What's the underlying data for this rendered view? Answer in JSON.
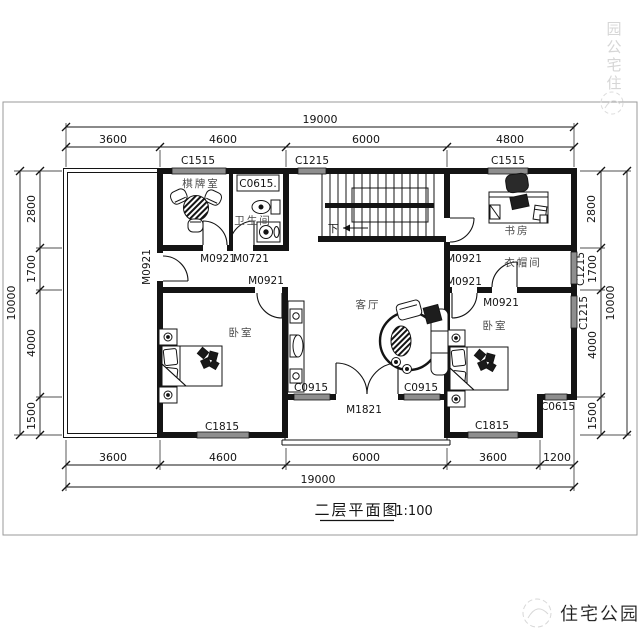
{
  "watermark": {
    "brand": "住宅公园",
    "vertical_chars": [
      "园",
      "公",
      "宅",
      "住"
    ]
  },
  "title": {
    "text": "二层平面图",
    "scale": "1:100"
  },
  "rooms": {
    "chess": "棋牌室",
    "bath": "卫生间",
    "study": "书房",
    "cloak": "衣帽间",
    "living": "客厅",
    "bed_left": "卧室",
    "bed_right": "卧室"
  },
  "stairs": {
    "down": "下"
  },
  "dims": {
    "top": {
      "overall": "19000",
      "segments": [
        "3600",
        "4600",
        "6000",
        "4800"
      ]
    },
    "bottom": {
      "overall": "19000",
      "segments": [
        "3600",
        "4600",
        "6000",
        "3600",
        "1200"
      ]
    },
    "left": {
      "overall": "10000",
      "segments": [
        "2800",
        "1700",
        "4000",
        "1500"
      ]
    },
    "right": {
      "overall": "10000",
      "segments": [
        "2800",
        "1700",
        "4000",
        "1500"
      ],
      "window_labels": [
        "C1215",
        "C1215"
      ]
    }
  },
  "windows": {
    "top_chess": "C1515",
    "top_stair": "C1215",
    "top_study": "C1515",
    "bath_box": "C0615.",
    "living_left": "C0915",
    "living_right": "C0915",
    "bed_left_bottom": "C1815",
    "bed_right_bottom": "C1815",
    "notch": "C0615"
  },
  "doors": {
    "terrace": "M0921",
    "chess": "M0921",
    "bath": "M0721",
    "study": "M0921",
    "bed_left": "M0921",
    "bed_right": "M0921",
    "cloak": "M0921",
    "balcony": "M1821"
  },
  "colors": {
    "ink": "#141414",
    "window_fill": "#8e8e8e",
    "room_label": "#4a4a4a",
    "watermark": "#d6d6d6"
  }
}
